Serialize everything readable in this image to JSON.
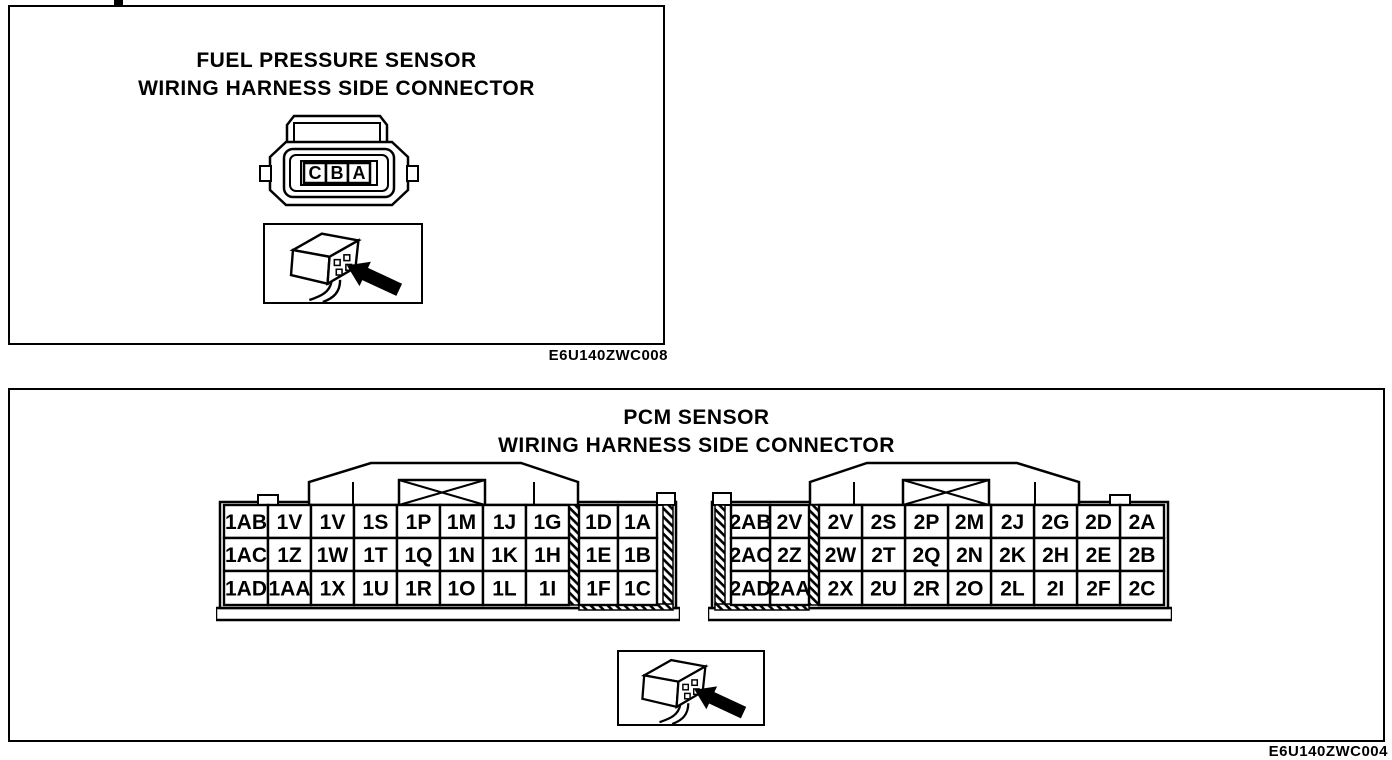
{
  "colors": {
    "ink": "#000000",
    "paper": "#ffffff"
  },
  "panels": [
    {
      "title_line1": "FUEL PRESSURE SENSOR",
      "title_line2": "WIRING HARNESS SIDE CONNECTOR",
      "caption": "E6U140ZWC008",
      "pins": [
        "C",
        "B",
        "A"
      ]
    },
    {
      "title_line1": "PCM SENSOR",
      "title_line2": "WIRING HARNESS SIDE CONNECTOR",
      "caption": "E6U140ZWC004",
      "connectors": [
        {
          "name": "pcm-connector-1",
          "rows": [
            [
              "1AB",
              "1V",
              "1V",
              "1S",
              "1P",
              "1M",
              "1J",
              "1G",
              "1D",
              "1A"
            ],
            [
              "1AC",
              "1Z",
              "1W",
              "1T",
              "1Q",
              "1N",
              "1K",
              "1H",
              "1E",
              "1B"
            ],
            [
              "1AD",
              "1AA",
              "1X",
              "1U",
              "1R",
              "1O",
              "1L",
              "1I",
              "1F",
              "1C"
            ]
          ]
        },
        {
          "name": "pcm-connector-2",
          "rows": [
            [
              "2AB",
              "2V",
              "2V",
              "2S",
              "2P",
              "2M",
              "2J",
              "2G",
              "2D",
              "2A"
            ],
            [
              "2AC",
              "2Z",
              "2W",
              "2T",
              "2Q",
              "2N",
              "2K",
              "2H",
              "2E",
              "2B"
            ],
            [
              "2AD",
              "2AA",
              "2X",
              "2U",
              "2R",
              "2O",
              "2L",
              "2I",
              "2F",
              "2C"
            ]
          ]
        }
      ]
    }
  ]
}
